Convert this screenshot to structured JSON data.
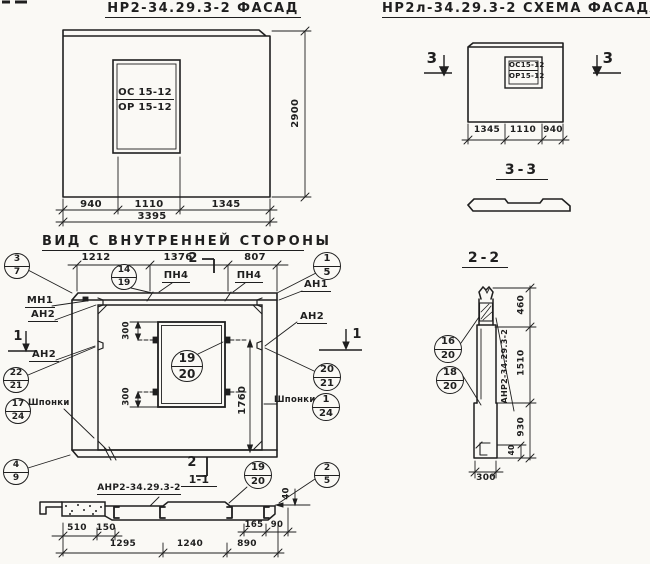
{
  "titles": {
    "facade": "НР2-34.29.3-2  ФАСАД",
    "scheme": "НР2л-34.29.3-2  СХЕМА ФАСАДА",
    "inner_view": "ВИД С ВНУТРЕННЕЙ СТОРОНЫ",
    "section_33": "3-3",
    "section_22": "2-2",
    "section_11": "1-1"
  },
  "colors": {
    "ink": "#1f1f1f",
    "paper": "#faf9f5"
  },
  "labels": [
    {
      "name": "facade-window-mark-top",
      "t": "ОС 15-12",
      "x": 116,
      "y": 88,
      "w": 58,
      "s": 10,
      "u": 1
    },
    {
      "name": "facade-window-mark-bottom",
      "t": "ОР 15-12",
      "x": 116,
      "y": 103,
      "w": 58,
      "s": 10
    },
    {
      "name": "facade-dim-940",
      "t": "940",
      "x": 73,
      "y": 200,
      "w": 36,
      "s": 10
    },
    {
      "name": "facade-dim-1110",
      "t": "1110",
      "x": 131,
      "y": 200,
      "w": 36,
      "s": 10
    },
    {
      "name": "facade-dim-1345",
      "t": "1345",
      "x": 208,
      "y": 200,
      "w": 36,
      "s": 10
    },
    {
      "name": "facade-dim-3395",
      "t": "3395",
      "x": 134,
      "y": 212,
      "w": 36,
      "s": 10
    },
    {
      "name": "facade-dim-2900",
      "t": "2900",
      "x": 276,
      "y": 108,
      "w": 40,
      "s": 10,
      "r": -90
    },
    {
      "name": "scheme-window-mark-top",
      "t": "ОС15-12",
      "x": 509,
      "y": 62,
      "w": 29,
      "s": 7,
      "u": 1
    },
    {
      "name": "scheme-window-mark-bottom",
      "t": "ОР15-12",
      "x": 509,
      "y": 73,
      "w": 29,
      "s": 7
    },
    {
      "name": "scheme-dim-1345",
      "t": "1345",
      "x": 469,
      "y": 126,
      "w": 36,
      "s": 9
    },
    {
      "name": "scheme-dim-1110",
      "t": "1110",
      "x": 506,
      "y": 126,
      "w": 34,
      "s": 9
    },
    {
      "name": "scheme-dim-940",
      "t": "940",
      "x": 540,
      "y": 126,
      "w": 26,
      "s": 9
    },
    {
      "name": "section3-mark-left",
      "t": "3",
      "x": 424,
      "y": 51,
      "w": 16,
      "s": 15
    },
    {
      "name": "section3-mark-right",
      "t": "3",
      "x": 600,
      "y": 51,
      "w": 16,
      "s": 15
    },
    {
      "name": "inner-dim-1212",
      "t": "1212",
      "x": 78,
      "y": 253,
      "w": 36,
      "s": 10
    },
    {
      "name": "inner-dim-1376",
      "t": "1376",
      "x": 160,
      "y": 253,
      "w": 36,
      "s": 10
    },
    {
      "name": "inner-dim-807",
      "t": "807",
      "x": 237,
      "y": 253,
      "w": 36,
      "s": 10
    },
    {
      "name": "section2-cut-mark-top",
      "t": "2",
      "x": 186,
      "y": 252,
      "w": 14,
      "s": 13
    },
    {
      "name": "pn4-label-1",
      "t": "ПН4",
      "x": 162,
      "y": 271,
      "w": 28,
      "s": 10,
      "u": 1
    },
    {
      "name": "pn4-label-2",
      "t": "ПН4",
      "x": 235,
      "y": 271,
      "w": 28,
      "s": 10,
      "u": 1
    },
    {
      "name": "an1-label",
      "t": "АН1",
      "x": 301,
      "y": 280,
      "w": 30,
      "s": 10,
      "u": 1
    },
    {
      "name": "mn1-label",
      "t": "МН1",
      "x": 25,
      "y": 296,
      "w": 30,
      "s": 10,
      "u": 1
    },
    {
      "name": "an2-label-left-top",
      "t": "АН2",
      "x": 28,
      "y": 310,
      "w": 30,
      "s": 10,
      "u": 1
    },
    {
      "name": "an2-label-left-mid",
      "t": "АН2",
      "x": 29,
      "y": 350,
      "w": 30,
      "s": 10,
      "u": 1
    },
    {
      "name": "an2-label-right",
      "t": "АН2",
      "x": 297,
      "y": 312,
      "w": 30,
      "s": 10,
      "u": 1
    },
    {
      "name": "section1-cut-mark-left",
      "t": "1",
      "x": 11,
      "y": 330,
      "w": 14,
      "s": 13
    },
    {
      "name": "section1-cut-mark-right",
      "t": "1",
      "x": 350,
      "y": 328,
      "w": 14,
      "s": 13
    },
    {
      "name": "shponki-label-left",
      "t": "Шпонки",
      "x": 28,
      "y": 399,
      "w": 38,
      "s": 8.5
    },
    {
      "name": "shponki-label-right",
      "t": "Шпонки",
      "x": 274,
      "y": 396,
      "w": 38,
      "s": 8.5
    },
    {
      "name": "window-dim-300-top",
      "t": "300",
      "x": 113,
      "y": 326,
      "w": 28,
      "s": 8.5,
      "r": -90
    },
    {
      "name": "window-dim-300-bottom",
      "t": "300",
      "x": 113,
      "y": 392,
      "w": 28,
      "s": 8.5,
      "r": -90
    },
    {
      "name": "inner-dim-1760",
      "t": "1760",
      "x": 226,
      "y": 395,
      "w": 34,
      "s": 10,
      "r": -90
    },
    {
      "name": "section2-cut-mark-bottom",
      "t": "2",
      "x": 185,
      "y": 456,
      "w": 14,
      "s": 13
    },
    {
      "name": "view-1-1-title",
      "t": "1-1",
      "x": 181,
      "y": 474,
      "w": 36,
      "s": 11,
      "u": 1
    },
    {
      "name": "anr2-label-bottom",
      "t": "АНР2-34.29.3-2",
      "x": 97,
      "y": 484,
      "w": 84,
      "s": 9,
      "u": 1
    },
    {
      "name": "sec11-dim-510",
      "t": "510",
      "x": 60,
      "y": 524,
      "w": 34,
      "s": 9
    },
    {
      "name": "sec11-dim-150",
      "t": "150",
      "x": 92,
      "y": 524,
      "w": 28,
      "s": 9
    },
    {
      "name": "sec11-dim-165",
      "t": "165",
      "x": 240,
      "y": 521,
      "w": 28,
      "s": 8.5
    },
    {
      "name": "sec11-dim-90",
      "t": "90",
      "x": 263,
      "y": 521,
      "w": 28,
      "s": 8.5
    },
    {
      "name": "sec11-dim-1295",
      "t": "1295",
      "x": 105,
      "y": 540,
      "w": 36,
      "s": 9
    },
    {
      "name": "sec11-dim-1240",
      "t": "1240",
      "x": 172,
      "y": 540,
      "w": 36,
      "s": 9
    },
    {
      "name": "sec11-dim-890",
      "t": "890",
      "x": 229,
      "y": 540,
      "w": 36,
      "s": 9
    },
    {
      "name": "sec11-dim-40",
      "t": "40",
      "x": 277,
      "y": 489,
      "w": 20,
      "s": 8.5,
      "r": -90
    },
    {
      "name": "sec22-dim-460",
      "t": "460",
      "x": 508,
      "y": 300,
      "w": 28,
      "s": 9,
      "r": -90
    },
    {
      "name": "sec22-dim-1510",
      "t": "1510",
      "x": 506,
      "y": 358,
      "w": 32,
      "s": 9,
      "r": -90
    },
    {
      "name": "sec22-dim-930",
      "t": "930",
      "x": 508,
      "y": 422,
      "w": 28,
      "s": 9,
      "r": -90
    },
    {
      "name": "sec22-dim-40",
      "t": "40",
      "x": 503,
      "y": 446,
      "w": 18,
      "s": 7.5,
      "r": -90
    },
    {
      "name": "sec22-dim-300",
      "t": "300",
      "x": 472,
      "y": 474,
      "w": 28,
      "s": 9
    },
    {
      "name": "anr2-label-vertical",
      "t": "АНР2-34.29.3-2",
      "x": 466,
      "y": 362,
      "w": 78,
      "s": 8,
      "r": -90
    }
  ],
  "callouts": [
    {
      "name": "callout-3-7",
      "x": 17,
      "y": 266,
      "rr": 13,
      "a": "3",
      "b": "7"
    },
    {
      "name": "callout-14-19",
      "x": 124,
      "y": 277,
      "rr": 13,
      "a": "14",
      "b": "19"
    },
    {
      "name": "callout-1-5",
      "x": 327,
      "y": 266,
      "rr": 14,
      "a": "1",
      "b": "5"
    },
    {
      "name": "callout-22-21",
      "x": 16,
      "y": 380,
      "rr": 13,
      "a": "22",
      "b": "21"
    },
    {
      "name": "callout-17-24",
      "x": 18,
      "y": 411,
      "rr": 13,
      "a": "17",
      "b": "24"
    },
    {
      "name": "callout-4-9",
      "x": 16,
      "y": 472,
      "rr": 13,
      "a": "4",
      "b": "9"
    },
    {
      "name": "callout-19-20-window",
      "x": 187,
      "y": 366,
      "rr": 16,
      "a": "19",
      "b": "20"
    },
    {
      "name": "callout-20-21",
      "x": 327,
      "y": 377,
      "rr": 14,
      "a": "20",
      "b": "21"
    },
    {
      "name": "callout-1-24",
      "x": 326,
      "y": 407,
      "rr": 14,
      "a": "1",
      "b": "24"
    },
    {
      "name": "callout-2-5",
      "x": 327,
      "y": 475,
      "rr": 13,
      "a": "2",
      "b": "5"
    },
    {
      "name": "callout-19-20-section",
      "x": 258,
      "y": 475,
      "rr": 14,
      "a": "19",
      "b": "20"
    },
    {
      "name": "callout-16-20",
      "x": 448,
      "y": 349,
      "rr": 14,
      "a": "16",
      "b": "20"
    },
    {
      "name": "callout-18-20",
      "x": 450,
      "y": 380,
      "rr": 14,
      "a": "18",
      "b": "20"
    }
  ]
}
